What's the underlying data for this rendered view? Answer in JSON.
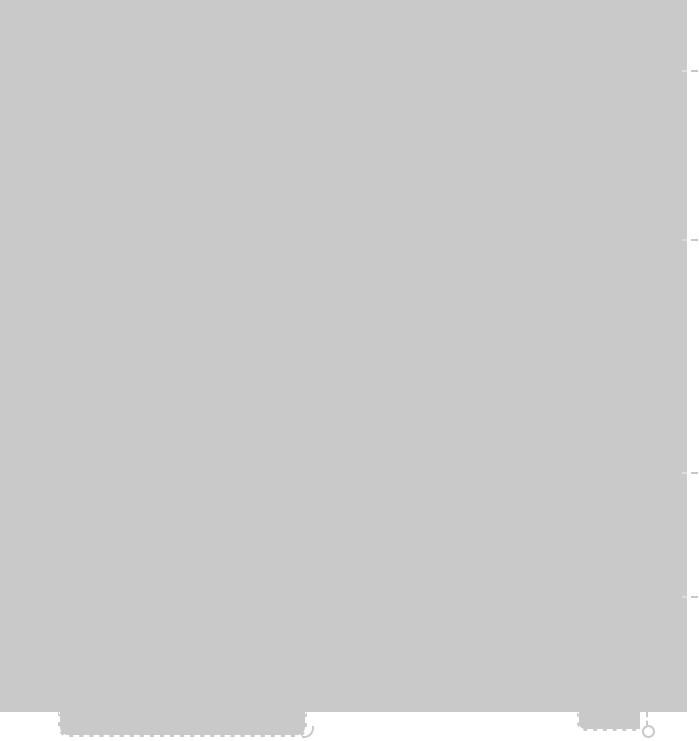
{
  "window": {
    "width": 699,
    "height": 741
  },
  "colors": {
    "background": "#ffffff",
    "overlay_gray": "#c9c9c9",
    "marker_dash": "#c8c8c8",
    "marker_tick": "#dcdcdc",
    "tab_outline": "#ffffff"
  },
  "scroll_markers": {
    "positions_y": [
      70,
      239,
      472,
      596
    ]
  },
  "bottom_elements": {
    "primary_tab": {
      "label": ""
    },
    "secondary_tab": {
      "label": ""
    },
    "handle_ring": {
      "label": ""
    }
  }
}
